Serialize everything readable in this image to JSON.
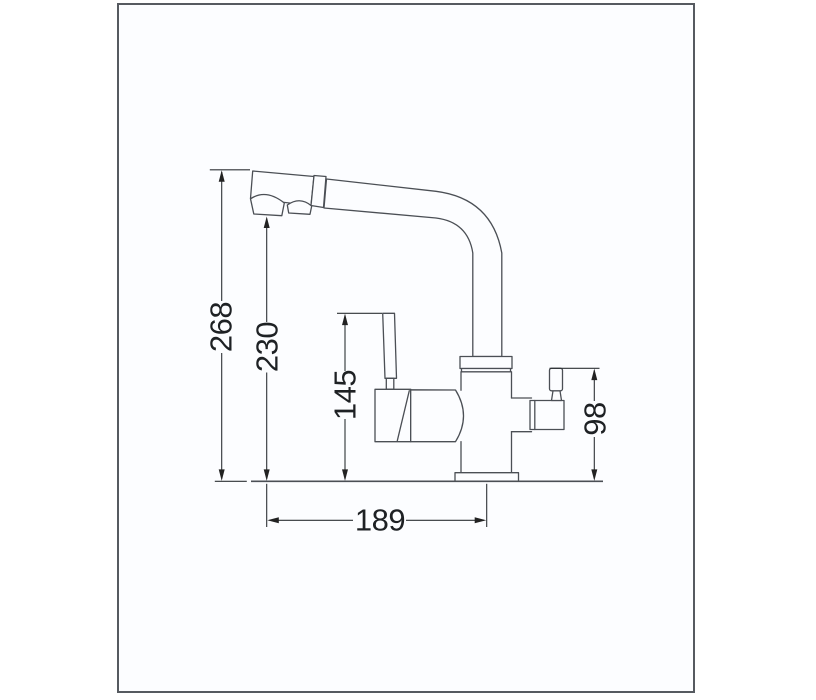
{
  "frame": {
    "border_color": "#565a60",
    "background": "#fcfdff"
  },
  "drawing": {
    "kind": "technical-dimension-drawing",
    "subject": "kitchen mixer faucet with pull-out spray head and side filter handle, front elevation",
    "line_color": "#4b4f55",
    "dimension_line_color": "#2e3236",
    "text_color": "#1e2124",
    "dimensions": {
      "overall_height": "268",
      "spout_outlet_height": "230",
      "lever_top_height": "145",
      "side_handle_height": "98",
      "horizontal_reach": "189"
    }
  }
}
